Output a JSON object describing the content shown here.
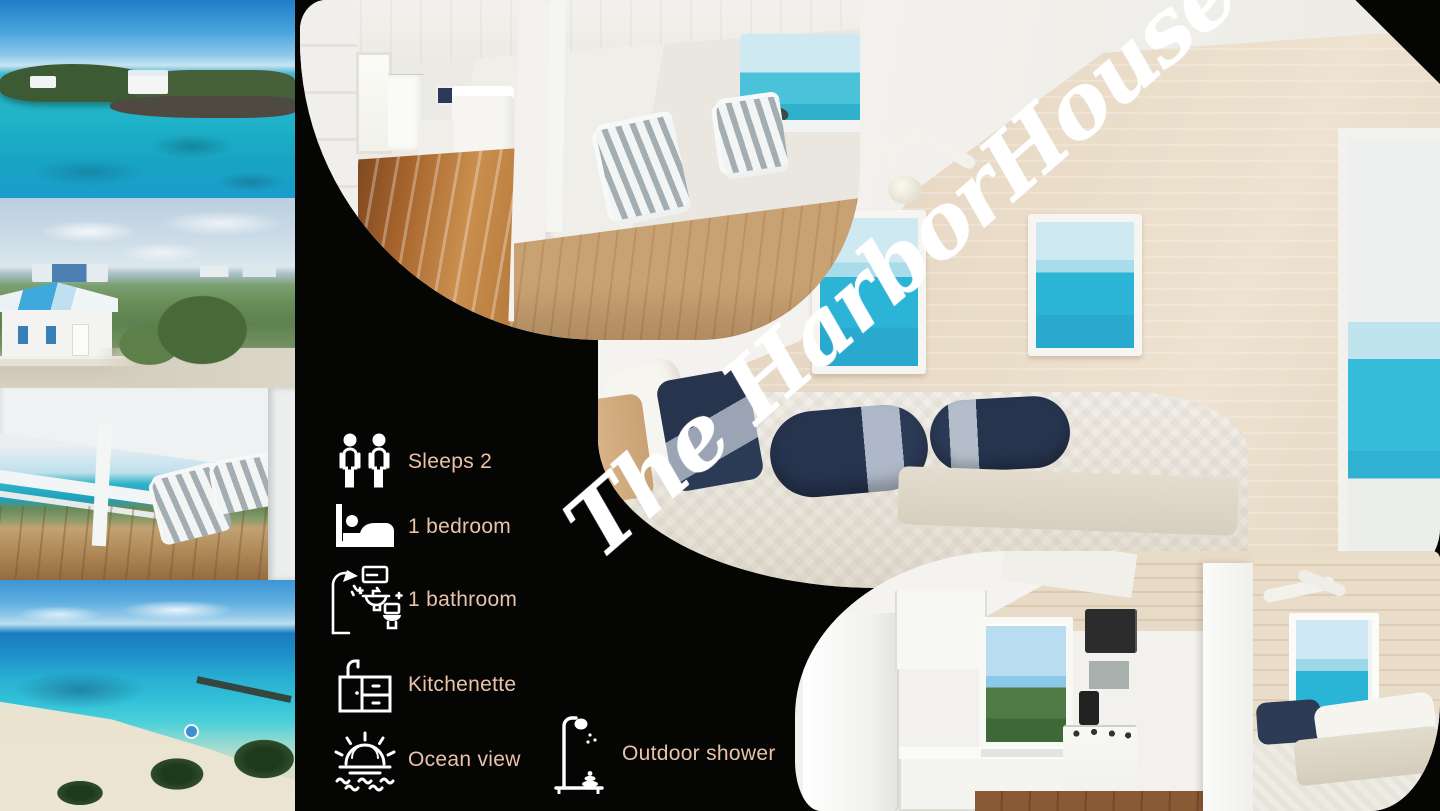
{
  "title": {
    "text": "The HarborHouse"
  },
  "amenities": [
    {
      "icon": "two-guests-icon",
      "label": "Sleeps 2"
    },
    {
      "icon": "bed-icon",
      "label": "1 bedroom"
    },
    {
      "icon": "bathroom-icon",
      "label": "1 bathroom"
    },
    {
      "icon": "kitchenette-icon",
      "label": "Kitchenette"
    },
    {
      "icon": "ocean-view-icon",
      "label": "Ocean view"
    },
    {
      "icon": "outdoor-shower-icon",
      "label": "Outdoor shower"
    }
  ],
  "photos": [
    {
      "label": "Island cove with cottage on rocky point"
    },
    {
      "label": "Beach cottage exterior with blue roof"
    },
    {
      "label": "Covered porch deck with ocean view"
    },
    {
      "label": "White sand beach aerial view"
    },
    {
      "label": "Porch and bedroom interior"
    },
    {
      "label": "Main bedroom with ocean view windows"
    },
    {
      "label": "Kitchenette and second bedroom"
    }
  ],
  "colors": {
    "background": "#050504",
    "label_text": "#e9c3a9",
    "title_text": "#ffffff"
  }
}
